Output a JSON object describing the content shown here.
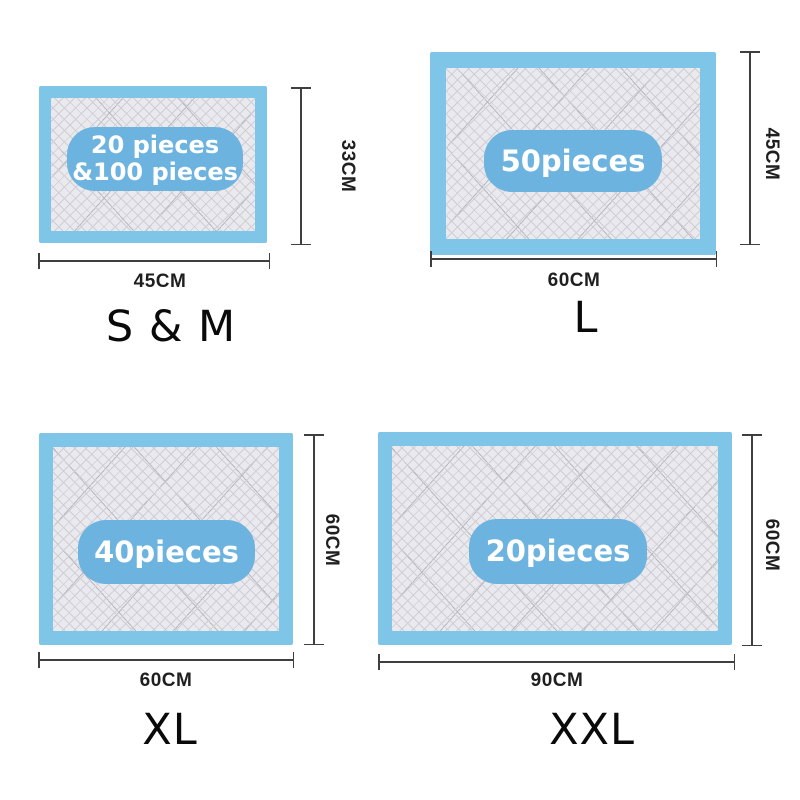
{
  "image_type": "product-size-diagram",
  "product": "disposable absorbent pet pads size chart",
  "colors": {
    "pad_border_blue": "#7ec5e8",
    "badge_blue": "#6cb3e0",
    "badge_text": "#ffffff",
    "mesh_bg": "#eae9ed",
    "mesh_line": "#cfced6",
    "mesh_fold": "#b8b7c0",
    "dim_line": "#3f3f3f",
    "dim_text": "#1f1f1f",
    "label_text": "#0a0a0a",
    "page_bg": "#ffffff"
  },
  "pads": [
    {
      "size_label": "S & M",
      "badge_lines": [
        "20 pieces",
        "&100 pieces"
      ],
      "width_label": "45CM",
      "height_label": "33CM"
    },
    {
      "size_label": "L",
      "badge_lines": [
        "50pieces"
      ],
      "width_label": "60CM",
      "height_label": "45CM"
    },
    {
      "size_label": "XL",
      "badge_lines": [
        "40pieces"
      ],
      "width_label": "60CM",
      "height_label": "60CM"
    },
    {
      "size_label": "XXL",
      "badge_lines": [
        "20pieces"
      ],
      "width_label": "90CM",
      "height_label": "60CM"
    }
  ]
}
